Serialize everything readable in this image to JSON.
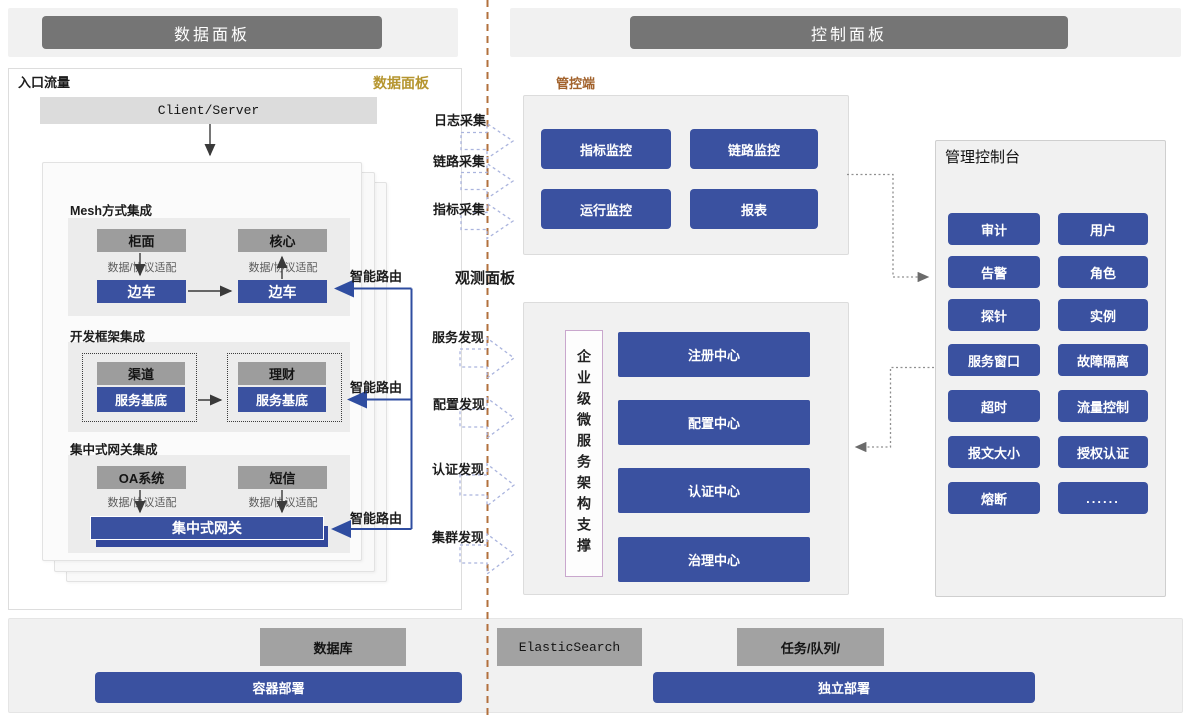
{
  "colors": {
    "accent_blue": "#3a51a0",
    "accent_blue_dark": "#32479b",
    "header_gray": "#757575",
    "panel_gray": "#f1f1f1",
    "box_gray": "#9d9d9d",
    "gold_label": "#b5952f",
    "brown_label": "#a2622c",
    "divider_brown": "#b2703d",
    "dashed_arrow_blue": "#aab4de"
  },
  "headers": {
    "data_plane": "数据面板",
    "control_plane": "控制面板"
  },
  "data_panel": {
    "entry_label": "入口流量",
    "corner_label": "数据面板",
    "client_server": "Client/Server",
    "smart_route": "智能路由",
    "mesh": {
      "title": "Mesh方式集成",
      "left_top": "柜面",
      "right_top": "核心",
      "adapter": "数据/协议适配",
      "left_bottom": "边车",
      "right_bottom": "边车"
    },
    "framework": {
      "title": "开发框架集成",
      "left_top": "渠道",
      "right_top": "理财",
      "left_bottom": "服务基底",
      "right_bottom": "服务基底"
    },
    "gateway": {
      "title": "集中式网关集成",
      "left_top": "OA系统",
      "right_top": "短信",
      "adapter": "数据/协议适配",
      "bar": "集中式网关"
    }
  },
  "flows": {
    "collect": [
      "日志采集",
      "链路采集",
      "指标采集"
    ],
    "observe_label": "观测面板",
    "discover": [
      "服务发现",
      "配置发现",
      "认证发现",
      "集群发现"
    ]
  },
  "control_panel": {
    "manage_label": "管控端",
    "monitors": [
      "指标监控",
      "链路监控",
      "运行监控",
      "报表"
    ],
    "support_vertical": "企业级微服务架构支撑",
    "centers": [
      "注册中心",
      "配置中心",
      "认证中心",
      "治理中心"
    ],
    "console": {
      "title": "管理控制台",
      "buttons": [
        "审计",
        "用户",
        "告警",
        "角色",
        "探针",
        "实例",
        "服务窗口",
        "故障隔离",
        "超时",
        "流量控制",
        "报文大小",
        "授权认证",
        "熔断",
        "......"
      ]
    }
  },
  "infrastructure": {
    "database": "数据库",
    "container_deploy": "容器部署",
    "elastic": "ElasticSearch",
    "queue": "任务/队列/",
    "standalone_deploy": "独立部署"
  }
}
